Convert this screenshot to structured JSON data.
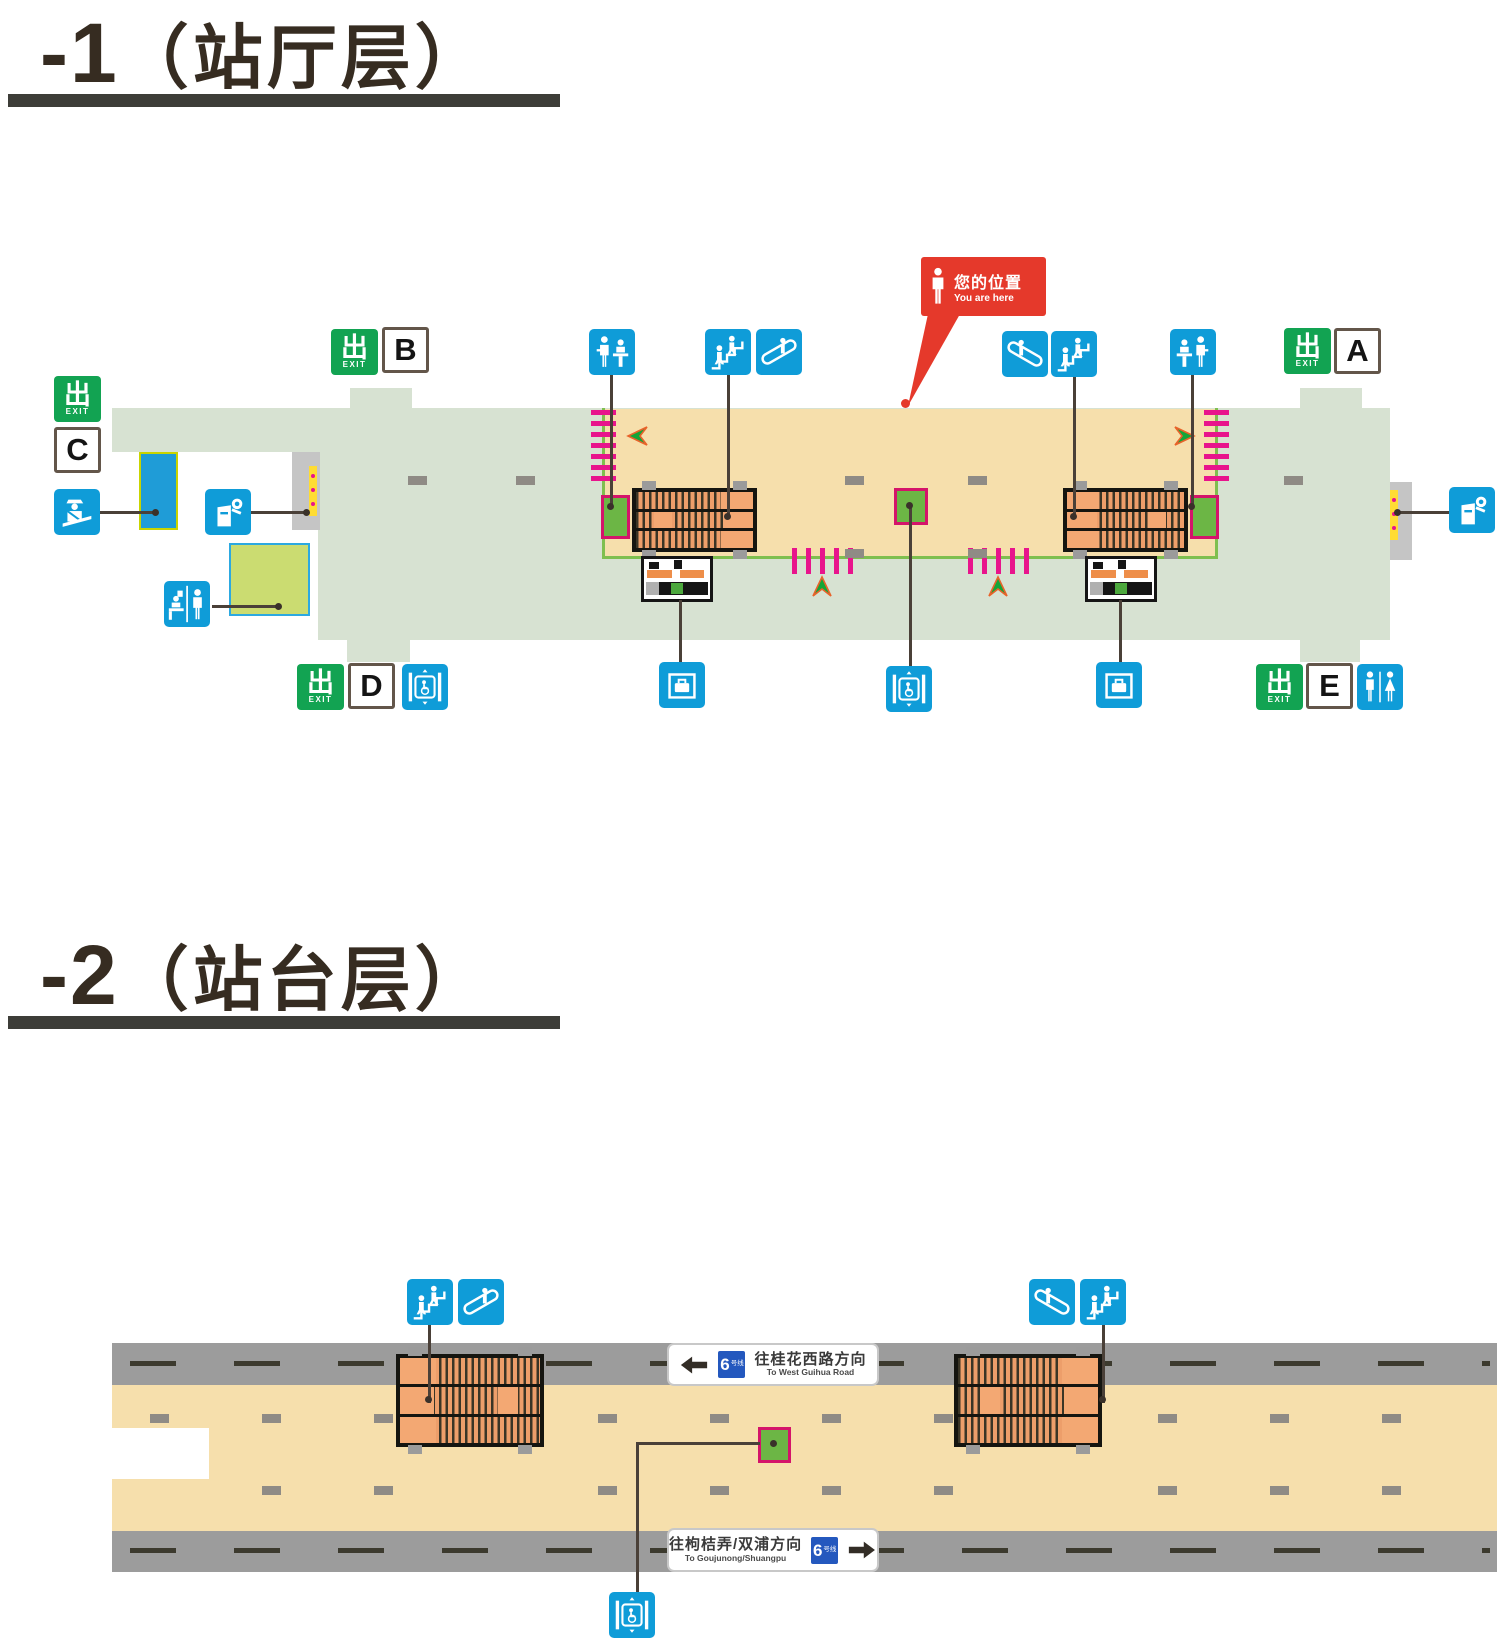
{
  "page": {
    "type": "metro-station-floor-plan"
  },
  "floors": [
    {
      "id": "concourse",
      "title_number": "-1",
      "title_name": "（站厅层）"
    },
    {
      "id": "platform",
      "title_number": "-2",
      "title_name": "（站台层）"
    }
  ],
  "you_are_here": {
    "zh": "您的位置",
    "en": "You are here"
  },
  "exit_sign": {
    "zh": "出",
    "en": "EXIT"
  },
  "exits": {
    "A": "A",
    "B": "B",
    "C": "C",
    "D": "D",
    "E": "E"
  },
  "direction_signs": {
    "up": {
      "zh": "往桂花西路方向",
      "en": "To West Guihua Road",
      "arrow": "left"
    },
    "down": {
      "zh": "往枸桔弄/双浦方向",
      "en": "To Goujunong/Shuangpu",
      "arrow": "right"
    }
  },
  "line_badge": {
    "number": "6",
    "suffix": "号线"
  },
  "icons": {
    "stairs": "stairs-icon",
    "escalator": "escalator-icon",
    "staffed_gate": "service-counter-icon",
    "customer_service": "customer-service-center-icon",
    "police": "police-post-icon",
    "ticket_machine": "ticket-vending-machine-icon",
    "luggage_xray": "luggage-security-check-icon",
    "accessible_elevator": "accessible-elevator-icon",
    "toilet": "toilet-icon"
  },
  "colors": {
    "exit_green": "#12A352",
    "icon_blue": "#0F9CD8",
    "paid_area": "#F6DFAC",
    "unpaid_area": "#D7E2D2",
    "gate_magenta": "#E8148C",
    "facility_green": "#6CB645",
    "block_orange": "#F2A36F",
    "track_gray": "#9C9C9C",
    "alert_red": "#E5392B",
    "line6_blue": "#2458BE"
  }
}
